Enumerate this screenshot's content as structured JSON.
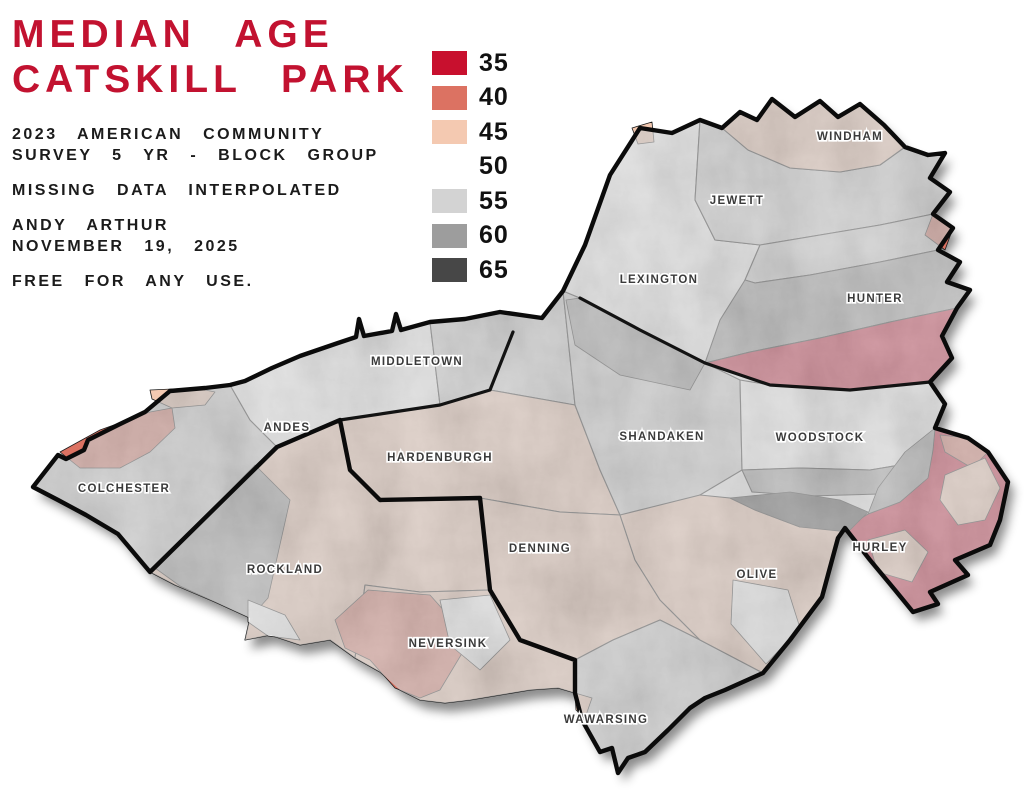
{
  "title": {
    "line1": "MEDIAN AGE",
    "line2": "CATSKILL PARK",
    "color": "#C21230"
  },
  "subtitle": {
    "line1": "2023 AMERICAN COMMUNITY",
    "line2": "SURVEY 5 YR - BLOCK GROUP"
  },
  "note": "MISSING DATA INTERPOLATED",
  "credit": {
    "line1": "ANDY ARTHUR",
    "line2": "NOVEMBER 19, 2025"
  },
  "license": "FREE FOR ANY USE.",
  "legend": {
    "entries": [
      {
        "label": "35",
        "color": "#C8102E"
      },
      {
        "label": "40",
        "color": "#DC7262"
      },
      {
        "label": "45",
        "color": "#F4C9B1"
      },
      {
        "label": "50",
        "color": "#FFFFFF"
      },
      {
        "label": "55",
        "color": "#D3D3D3"
      },
      {
        "label": "60",
        "color": "#9D9D9D"
      },
      {
        "label": "65",
        "color": "#474747"
      }
    ]
  },
  "map": {
    "value_colors": {
      "35": "#C8102E",
      "40": "#DC7262",
      "45": "#F4C9B1",
      "50": "#FFFFFF",
      "55": "#D3D3D3",
      "60": "#9D9D9D",
      "65": "#474747"
    },
    "outline_color": "#0b0b0b",
    "town_line_color": "#1a1a1a",
    "outline": "33,487 58,455 66,459 84,450 88,440 118,425 145,412 170,391 205,388 230,385 245,381 272,368 300,356 338,343 356,337 359,319 364,336 392,331 396,314 401,330 430,322 465,319 500,312 542,318 563,291 585,245 610,175 640,128 672,133 700,120 722,128 740,112 757,120 772,99 795,117 820,101 838,117 860,104 884,125 905,147 928,155 945,153 930,178 950,192 933,214 953,228 938,250 960,262 947,282 970,290 957,308 942,336 952,358 930,382 945,404 935,428 968,438 988,452 1008,482 1000,520 990,545 955,560 968,575 930,592 938,604 913,612 895,590 870,560 845,528 838,538 822,597 790,640 763,673 725,690 705,698 690,708 668,730 645,752 628,758 618,773 612,748 600,752 582,720 575,693 575,660 520,640 490,590 480,498 380,500 350,470 340,420 277,447 150,572 118,534 86,515 58,500",
    "park_silhouette": "33,487 58,455 66,459 84,450 88,440 118,425 145,412 170,391 205,388 230,385 245,381 272,368 300,356 338,343 356,337 359,319 364,336 392,331 396,314 401,330 430,322 465,319 500,312 542,318 563,291 585,245 610,175 640,128 672,133 700,120 722,128 740,112 757,120 772,99 795,117 820,101 838,117 860,104 884,125 905,147 928,155 945,153 930,178 950,192 933,214 953,228 938,250 960,262 947,282 970,290 957,308 942,336 952,358 930,382 945,404 935,428 968,438 988,452 1008,482 1000,520 990,545 955,560 968,575 930,592 938,604 913,612 895,590 870,560 845,528 838,538 822,597 790,640 763,673 725,690 705,698 690,708 668,730 645,752 628,758 618,773 612,748 600,752 582,720 575,693 558,688 530,690 500,695 470,700 445,703 420,700 400,690 380,672 355,658 330,640 300,645 270,635 245,640 250,618 215,602 175,585 150,572 118,534 86,515 58,500",
    "regions": [
      {
        "id": "colchester",
        "name": "Colchester",
        "value": 55,
        "points": "33,487 58,455 66,459 84,450 88,440 118,425 145,412 170,391 205,388 230,385 250,420 277,447 150,572 118,534 86,515 58,500"
      },
      {
        "id": "andes",
        "name": "Andes",
        "value": 50,
        "points": "230,385 245,381 272,368 300,356 338,343 356,337 359,319 364,336 392,331 396,314 401,330 430,322 440,405 340,420 277,447 250,420"
      },
      {
        "id": "middletown",
        "name": "Middletown",
        "value": 55,
        "points": "430,322 465,319 500,312 542,318 563,291 575,405 490,390 440,405"
      },
      {
        "id": "hardenburgh",
        "name": "Hardenburgh",
        "value": 45,
        "points": "340,420 440,405 490,390 575,405 600,470 620,515 560,512 480,498 380,500 350,470"
      },
      {
        "id": "rockland",
        "name": "Rockland",
        "value": 45,
        "points": "150,572 277,447 340,420 350,470 380,500 480,498 490,590 420,592 365,585 355,658 330,640 300,645 270,635 245,640 250,618 215,602 175,585"
      },
      {
        "id": "neversink",
        "name": "Neversink",
        "value": 45,
        "points": "365,585 420,592 490,590 520,640 575,660 575,693 558,688 530,690 500,695 470,700 445,703 420,700 400,690 380,672 355,658"
      },
      {
        "id": "denning",
        "name": "Denning",
        "value": 45,
        "points": "480,498 560,512 620,515 635,560 660,600 700,640 660,620 613,640 575,660 520,640 490,590"
      },
      {
        "id": "wawarsing",
        "name": "Wawarsing",
        "value": 55,
        "points": "575,660 613,640 660,620 700,640 763,673 725,690 705,698 690,708 668,730 645,752 628,758 618,773 612,748 600,752 582,720 575,693"
      },
      {
        "id": "shandaken",
        "name": "Shandaken",
        "value": 55,
        "points": "563,291 580,298 640,330 705,363 740,380 742,470 700,495 640,520 620,515 600,470 575,405"
      },
      {
        "id": "olive",
        "name": "Olive",
        "value": 45,
        "points": "620,515 700,495 730,498 755,510 800,527 845,528 838,538 822,597 790,640 763,673 700,640 660,600 635,560"
      },
      {
        "id": "woodstock",
        "name": "Woodstock",
        "value": 50,
        "points": "740,380 770,385 850,390 930,382 945,404 935,428 930,460 870,470 800,468 742,470"
      },
      {
        "id": "woodstock-south-band",
        "name": "Woodstock south band",
        "value": 60,
        "points": "742,470 800,468 870,470 930,460 935,480 880,494 810,496 752,492"
      },
      {
        "id": "lexington",
        "name": "Lexington",
        "value": 50,
        "points": "563,291 585,245 610,175 640,128 672,133 700,120 695,200 715,240 760,245 745,280 705,363 640,330 580,298"
      },
      {
        "id": "jewett",
        "name": "Jewett",
        "value": 55,
        "points": "700,120 722,128 748,150 790,168 840,172 880,165 905,147 928,155 945,153 930,178 950,192 933,214 880,225 820,235 760,245 715,240 695,200"
      },
      {
        "id": "windham",
        "name": "Windham",
        "value": 45,
        "points": "722,128 740,112 757,120 772,99 795,117 820,101 838,117 860,104 884,125 905,147 880,165 840,172 790,168 748,150"
      },
      {
        "id": "hunter-north-band",
        "name": "Hunter north band",
        "value": 55,
        "points": "745,280 760,245 820,235 880,225 933,214 953,228 938,250 880,262 810,275 755,283"
      },
      {
        "id": "hunter-dark-band",
        "name": "Hunter dark band",
        "value": 60,
        "points": "745,280 755,283 810,275 880,262 938,250 960,262 947,282 970,290 957,308 890,322 820,338 750,352 705,363 720,320"
      },
      {
        "id": "hunter",
        "name": "Hunter",
        "value": 35,
        "points": "705,363 750,352 820,338 890,322 957,308 942,336 952,358 930,382 850,390 770,385"
      },
      {
        "id": "hurley",
        "name": "Hurley",
        "value": 35,
        "points": "935,428 968,438 988,452 1008,482 1000,520 990,545 955,560 968,575 930,592 938,604 913,612 895,590 870,560 845,528 868,514 900,502 925,480 932,455"
      }
    ],
    "patches": [
      {
        "id": "colchester-salmon",
        "value": 40,
        "points": "60,452 100,430 150,412 172,408 175,428 150,452 120,468 80,468"
      },
      {
        "id": "colchester-peach",
        "value": 45,
        "points": "150,390 195,388 215,392 205,405 172,408 152,399"
      },
      {
        "id": "rockland-dark",
        "value": 60,
        "points": "155,568 255,465 290,500 268,598 250,618 215,602 180,586"
      },
      {
        "id": "rockland-white",
        "value": 50,
        "points": "248,600 285,615 300,640 268,636 248,622"
      },
      {
        "id": "shandaken-dark",
        "value": 60,
        "points": "566,300 580,298 640,330 705,363 690,390 620,375 575,345"
      },
      {
        "id": "olive-woodstock-dark65",
        "value": 65,
        "points": "730,498 790,492 840,500 868,512 848,532 800,527 755,510"
      },
      {
        "id": "neversink-salmon",
        "value": 40,
        "points": "368,590 430,595 470,640 440,690 420,698 395,688 370,660 345,648 335,620"
      },
      {
        "id": "neversink-white",
        "value": 50,
        "points": "440,600 490,595 510,640 480,670 450,645"
      },
      {
        "id": "olive-white",
        "value": 50,
        "points": "733,580 788,590 800,628 766,664 731,624"
      },
      {
        "id": "hurley-gray",
        "value": 60,
        "points": "868,514 900,502 928,478 933,450 935,428 905,452 878,488"
      },
      {
        "id": "hurley-salmon-top",
        "value": 40,
        "points": "940,435 968,438 988,452 972,468 945,452"
      },
      {
        "id": "hurley-peach-ne",
        "value": 45,
        "points": "945,475 985,458 1000,488 985,520 958,525 940,500"
      },
      {
        "id": "hurley-peach-center",
        "value": 45,
        "points": "868,540 905,530 928,552 912,582 878,572"
      },
      {
        "id": "jewett-salmon-edge",
        "value": 40,
        "points": "933,214 953,228 945,250 925,235"
      },
      {
        "id": "lexington-peach-corner",
        "value": 45,
        "points": "632,128 652,122 654,142 638,144"
      },
      {
        "id": "wawarsing-peach",
        "value": 45,
        "points": "575,693 592,698 585,718 576,710"
      }
    ],
    "county_lines": [
      {
        "id": "delaware-ulster",
        "points": "150,572 277,447 340,420 440,405 490,390 513,332"
      },
      {
        "id": "greene-ulster",
        "points": "580,298 640,330 705,363 770,385 850,390 930,382"
      },
      {
        "id": "ulster-sullivan",
        "points": "480,498 490,590 520,640 575,660 575,693"
      }
    ],
    "labels": [
      {
        "text": "WINDHAM",
        "x": 850,
        "y": 140
      },
      {
        "text": "JEWETT",
        "x": 737,
        "y": 204
      },
      {
        "text": "LEXINGTON",
        "x": 659,
        "y": 283
      },
      {
        "text": "HUNTER",
        "x": 875,
        "y": 302
      },
      {
        "text": "MIDDLETOWN",
        "x": 417,
        "y": 365
      },
      {
        "text": "ANDES",
        "x": 287,
        "y": 431
      },
      {
        "text": "COLCHESTER",
        "x": 124,
        "y": 492
      },
      {
        "text": "HARDENBURGH",
        "x": 440,
        "y": 461
      },
      {
        "text": "SHANDAKEN",
        "x": 662,
        "y": 440
      },
      {
        "text": "WOODSTOCK",
        "x": 820,
        "y": 441
      },
      {
        "text": "ROCKLAND",
        "x": 285,
        "y": 573
      },
      {
        "text": "DENNING",
        "x": 540,
        "y": 552
      },
      {
        "text": "OLIVE",
        "x": 757,
        "y": 578
      },
      {
        "text": "NEVERSINK",
        "x": 448,
        "y": 647
      },
      {
        "text": "HURLEY",
        "x": 880,
        "y": 551
      },
      {
        "text": "WAWARSING",
        "x": 606,
        "y": 723
      }
    ]
  }
}
